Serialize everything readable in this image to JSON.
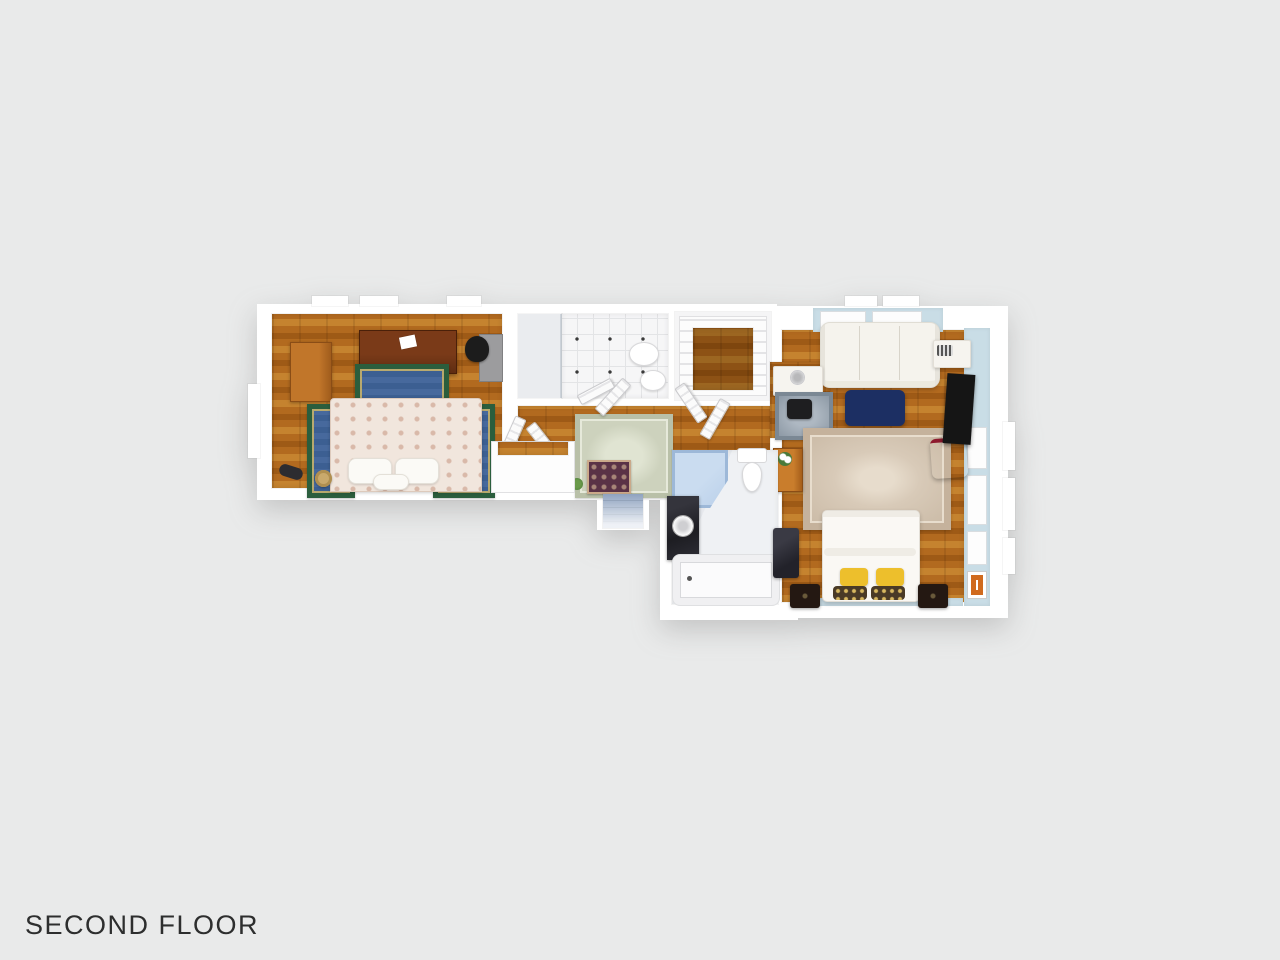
{
  "title": {
    "label": "SECOND FLOOR"
  },
  "palette": {
    "background": "#e9eaea",
    "wall": "#ffffff",
    "wall_blue": "#c9dde6",
    "wood_light": "#c5832f",
    "wood_mid": "#b26a1f",
    "wood_dark": "#9e5a16",
    "tile": "#f6f6f7",
    "marble": "#eff1f4",
    "rug_blue": "#3c5f92",
    "rug_green": "#2b5e3d",
    "rug_sage": "#cdd2bd",
    "rug_beige": "#d8cab8",
    "rug_beige_border": "#c5b29c",
    "rug_gray": "#8d99a5",
    "runner": "#5a3246",
    "duvet": "#f1e6dd",
    "duvet_accent": "#d9b9a9",
    "sofa": "#f5f3ed",
    "ottoman": "#1c2f63",
    "chair_red": "#a62039",
    "tv": "#151515",
    "pillow_yellow": "#edbf2c",
    "nightstand": "#241812",
    "dresser": "#5f2d12",
    "wardrobe": "#c1762a",
    "shower_blue": "#b9cfe9",
    "vanity_black": "#1d1d22",
    "stair_blue": "#8fa3c0",
    "plant_green": "#4a7a3a"
  }
}
